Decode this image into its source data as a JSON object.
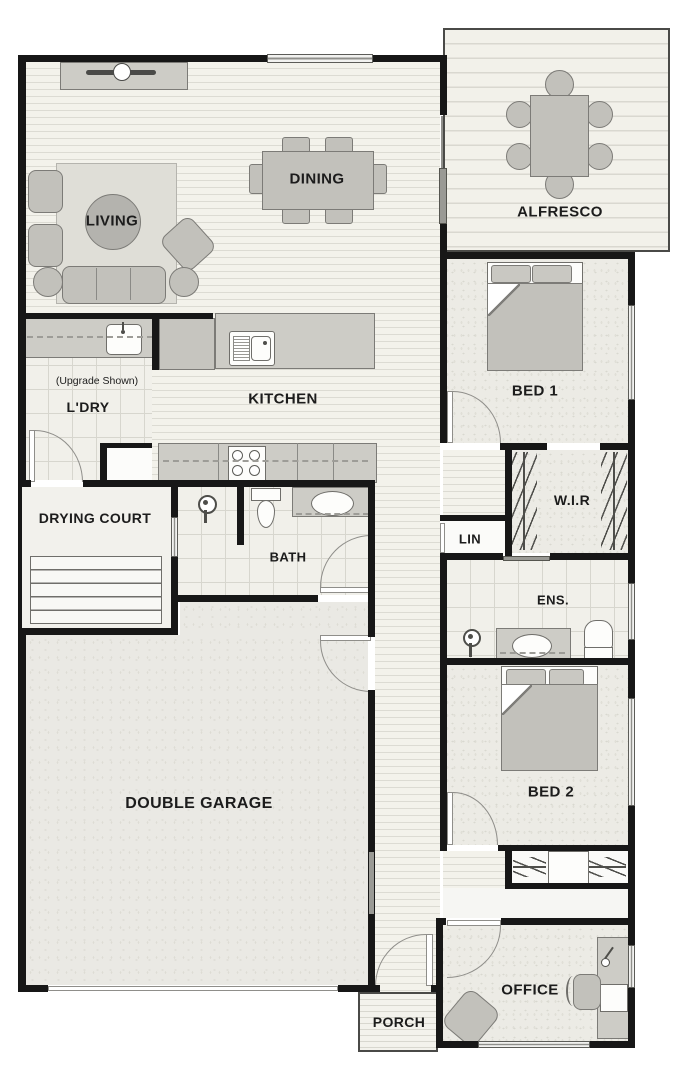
{
  "plan": {
    "type": "residential-floor-plan",
    "rooms": {
      "living": {
        "label": "LIVING"
      },
      "dining": {
        "label": "DINING"
      },
      "alfresco": {
        "label": "ALFRESCO"
      },
      "laundry": {
        "label": "L'DRY",
        "note": "(Upgrade Shown)"
      },
      "kitchen": {
        "label": "KITCHEN"
      },
      "bed1": {
        "label": "BED 1"
      },
      "wir": {
        "label": "W.I.R"
      },
      "lin": {
        "label": "LIN"
      },
      "drying_court": {
        "label": "DRYING COURT"
      },
      "ens": {
        "label": "ENS."
      },
      "bath": {
        "label": "BATH"
      },
      "garage": {
        "label": "DOUBLE GARAGE"
      },
      "bed2": {
        "label": "BED 2"
      },
      "office": {
        "label": "OFFICE"
      },
      "porch": {
        "label": "PORCH"
      }
    },
    "colors": {
      "wall": "#171717",
      "furniture": "#c2c1bb",
      "timber_floor": "#f3f2eb",
      "carpet": "#ecebe5",
      "tile": "#f1f0ea",
      "concrete": "#eae9e4"
    }
  }
}
